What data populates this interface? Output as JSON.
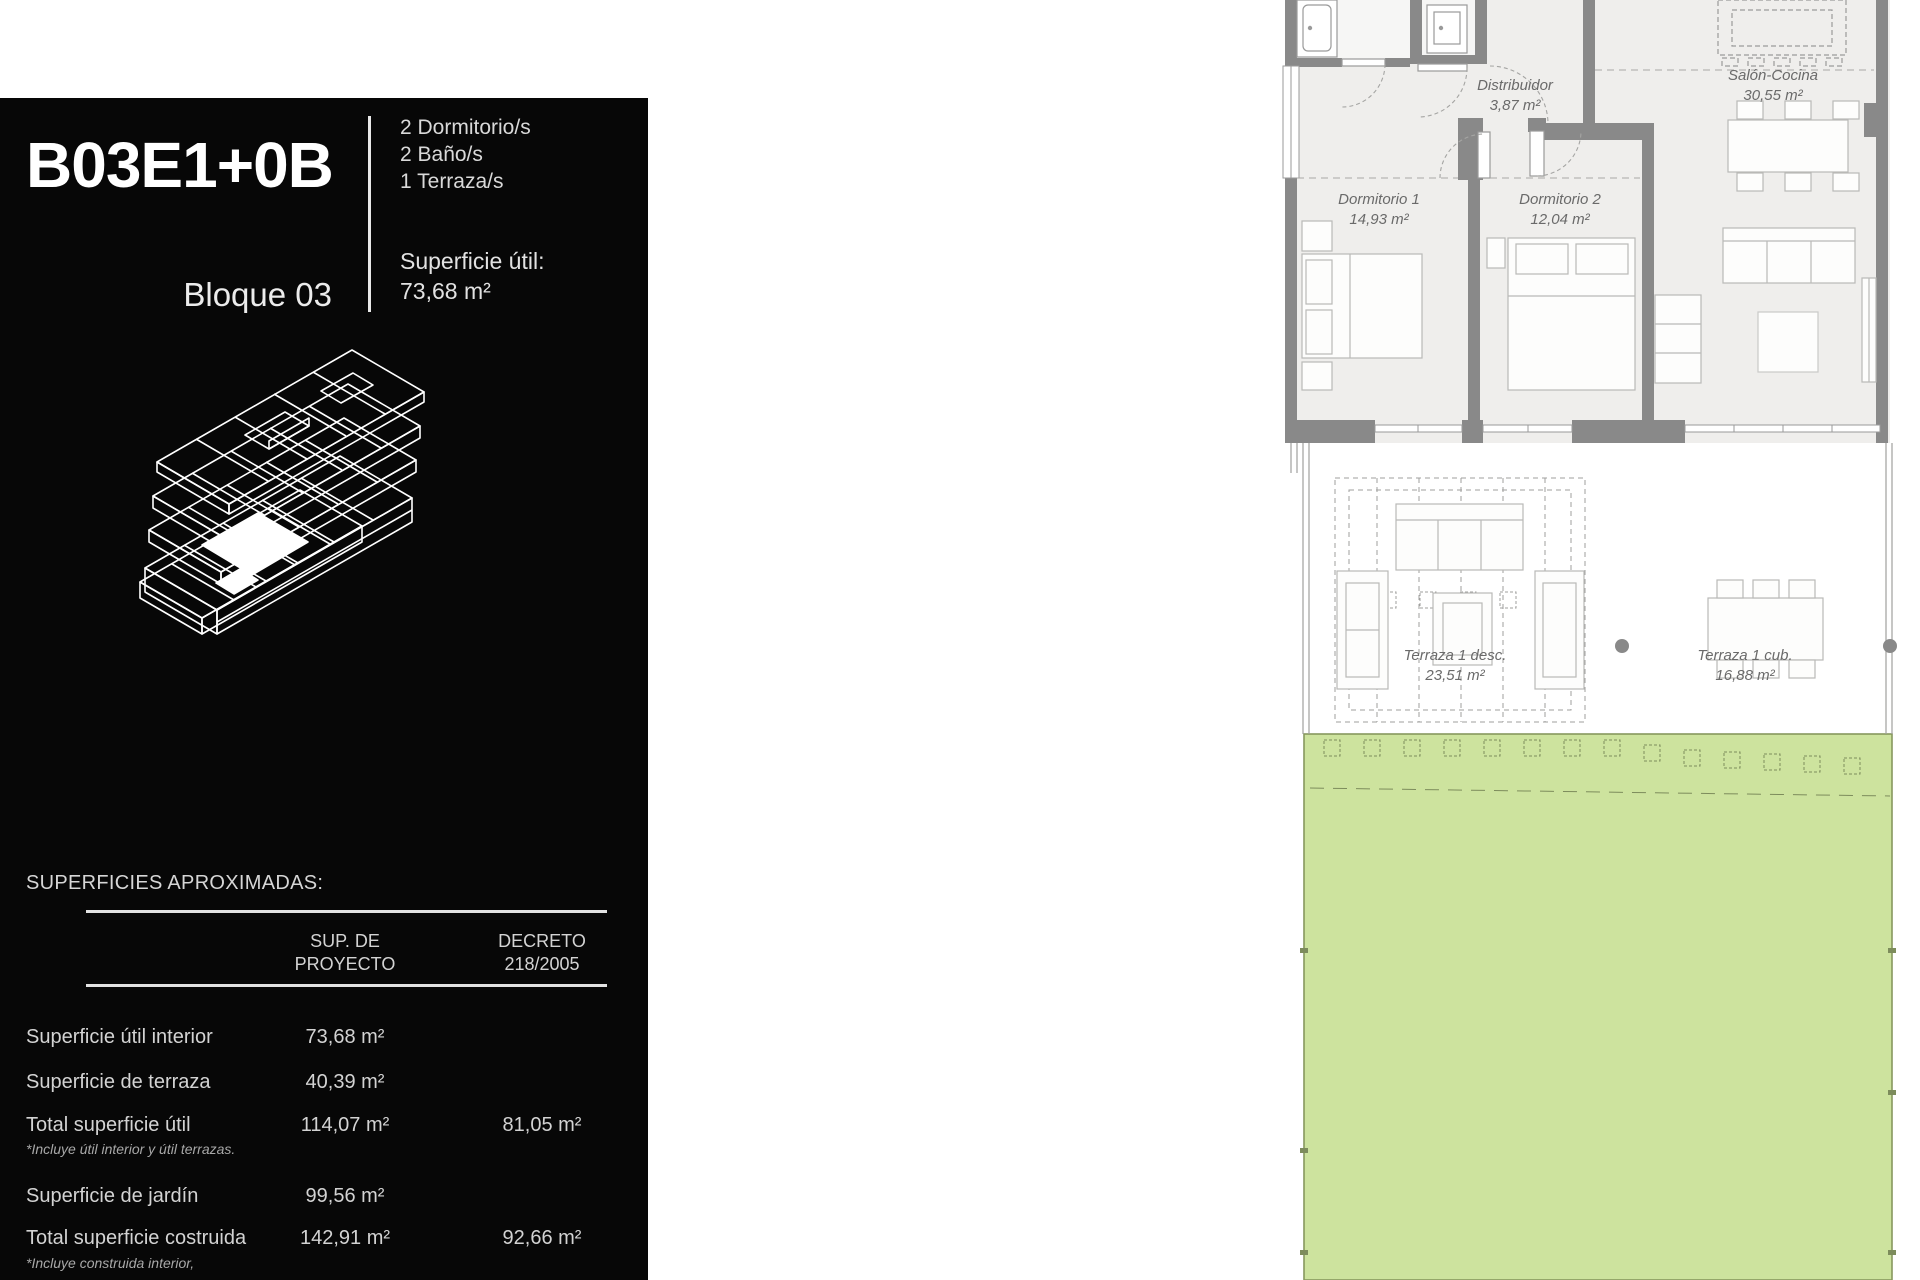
{
  "panel": {
    "unit_code": "B03E1+0B",
    "block": "Bloque 03",
    "specs": [
      "2 Dormitorio/s",
      "2 Baño/s",
      "1 Terraza/s"
    ],
    "useful_area_label": "Superficie útil:",
    "useful_area_value": "73,68 m²",
    "surfaces_title": "SUPERFICIES APROXIMADAS:",
    "table": {
      "col1_header_line1": "SUP. DE",
      "col1_header_line2": "PROYECTO",
      "col2_header_line1": "DECRETO",
      "col2_header_line2": "218/2005",
      "rows": [
        {
          "label": "Superficie útil interior",
          "proyecto": "73,68 m²",
          "decreto": ""
        },
        {
          "label": "Superficie de terraza",
          "proyecto": "40,39 m²",
          "decreto": ""
        },
        {
          "label": "Total superficie útil",
          "proyecto": "114,07 m²",
          "decreto": "81,05 m²",
          "note": "*Incluye útil interior y útil terrazas."
        },
        {
          "label": "Superficie de jardín",
          "proyecto": "99,56 m²",
          "decreto": ""
        },
        {
          "label": "Total superficie costruida",
          "proyecto": "142,91 m²",
          "decreto": "92,66 m²",
          "note": "*Incluye construida interior,"
        }
      ]
    }
  },
  "plan": {
    "rooms": [
      {
        "name": "Distribuidor",
        "area": "3,87 m²"
      },
      {
        "name": "Salón-Cocina",
        "area": "30,55 m²"
      },
      {
        "name": "Dormitorio 1",
        "area": "14,93 m²"
      },
      {
        "name": "Dormitorio 2",
        "area": "12,04 m²"
      },
      {
        "name": "Terraza 1 desc.",
        "area": "23,51 m²"
      },
      {
        "name": "Terraza 1 cub.",
        "area": "16,88 m²"
      }
    ],
    "colors": {
      "garden": "#cde39e",
      "wall": "#898989",
      "floor": "#efeeec",
      "accent_line": "#87985e"
    }
  }
}
